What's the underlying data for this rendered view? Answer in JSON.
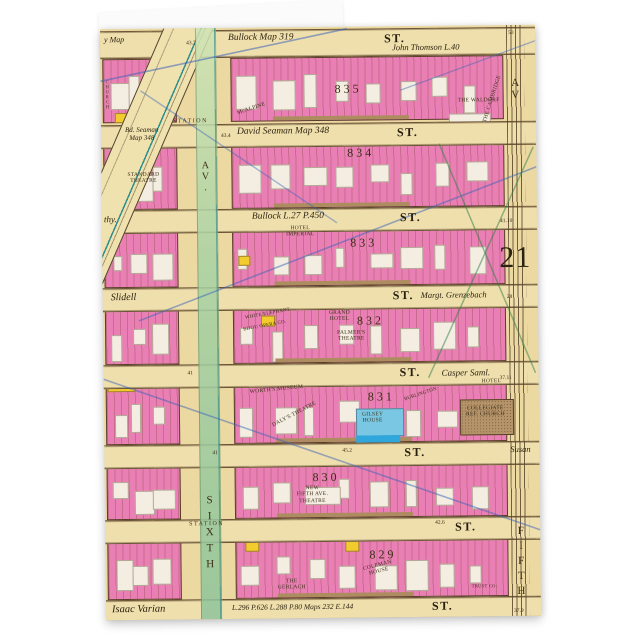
{
  "map": {
    "plate_number": "21",
    "colors": {
      "map_background": "#EBD9A1",
      "street_tan": "#EFDFAD",
      "block_pink": "#E97FB4",
      "building_white": "#F3EEE1",
      "building_yellow": "#F2CB2E",
      "store_brown": "#AD8C60",
      "avenue_green": "#A9D2A4",
      "gilsey_blue": "#79C7E2",
      "church_brown": "#B5946A",
      "pencil_blue": "#3C64B9",
      "pencil_green": "#2D7D46",
      "ink": "#3c2f18",
      "card_white": "#FBFBFB"
    },
    "streets": [
      {
        "west": "y Map",
        "mid": "Bullock Map 319",
        "st": "ST.",
        "east": "John Thomson L.40",
        "num": "50"
      },
      {
        "west": "Bd. Seaman\nMap 348",
        "station": "STATION",
        "mid": "David Seaman Map 348",
        "st": "ST.",
        "num": "43.4"
      },
      {
        "west": "thy.",
        "mid": "Bullock L.27 P.450",
        "st": "ST.",
        "num": "41.10"
      },
      {
        "west": "Slidell",
        "st": "ST.",
        "east": "Margt. Grenzebach",
        "num": "28"
      },
      {
        "marker": "41",
        "st": "ST.",
        "east": "Casper Saml.",
        "num": "37.11"
      },
      {
        "marker": "41",
        "west": "45.2",
        "st": "ST.",
        "east": "Susan"
      },
      {
        "station": "STATION",
        "st": "ST.",
        "num": "42.6"
      },
      {
        "west": "Isaac Varian",
        "mid": "L.296 P.626 L.288 P.80 Maps 232 E.144",
        "st": "ST.",
        "num": "37.9"
      }
    ],
    "avenues": {
      "sixth": {
        "label": "AV.",
        "name": "SIXTH"
      },
      "fifth": {
        "label": "AV",
        "name": "FIFTH"
      },
      "broadway": {
        "name": "BROADWAY"
      }
    },
    "numbers": {
      "top_left": "43.7"
    },
    "blocks": [
      {
        "number": "835"
      },
      {
        "number": "834"
      },
      {
        "number": "833"
      },
      {
        "number": "832"
      },
      {
        "number": "831"
      },
      {
        "number": "830"
      },
      {
        "number": "829"
      }
    ],
    "landmarks": [
      {
        "text": "THE WALDORF"
      },
      {
        "text": "McALPINE"
      },
      {
        "text": "THE CAMBRIDGE"
      },
      {
        "text": "CHURCH"
      },
      {
        "text": "STANDARD\nTHEATRE"
      },
      {
        "text": "HOTEL\nIMPERIAL"
      },
      {
        "text": "GRAND\nHOTEL"
      },
      {
        "text": "PALMER'S\nTHEATRE"
      },
      {
        "text": "WHITE ELEPHANT"
      },
      {
        "text": "BIJOU OPERA CO."
      },
      {
        "text": "WORTH'S MUSEUM"
      },
      {
        "text": "DALY'S THEATRE"
      },
      {
        "text": "GILSEY\nHOUSE"
      },
      {
        "text": "HOTEL"
      },
      {
        "text": "BURLINGTON"
      },
      {
        "text": "COLLEGIATE\nREF. CHURCH"
      },
      {
        "text": "NEW\nFIFTH AVE.\nTHEATRE"
      },
      {
        "text": "COLEMAN\nHOUSE"
      },
      {
        "text": "THE\nGERLACH"
      },
      {
        "text": "TRUST CO."
      }
    ]
  }
}
